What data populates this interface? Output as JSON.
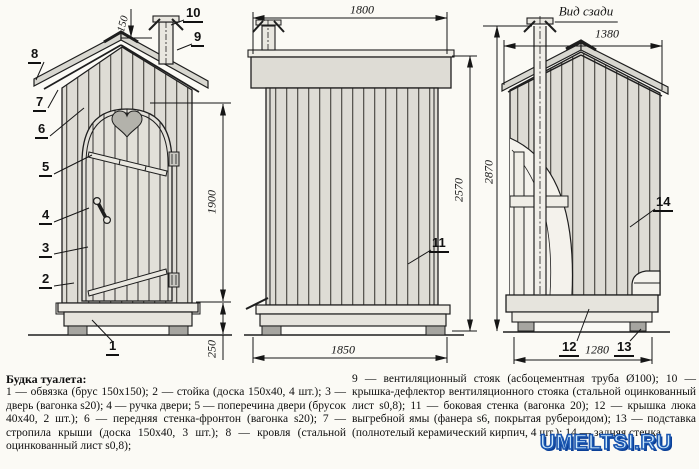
{
  "views": {
    "front": {
      "dim_150": "150",
      "dim_1900": "1900",
      "dim_250": "250"
    },
    "side": {
      "dim_1800": "1800",
      "dim_1850": "1850",
      "dim_2570": "2570"
    },
    "back": {
      "title": "Вид сзади",
      "dim_1380": "1380",
      "dim_2870": "2870",
      "dim_1280": "1280"
    }
  },
  "callouts": {
    "c1": "1",
    "c2": "2",
    "c3": "3",
    "c4": "4",
    "c5": "5",
    "c6": "6",
    "c7": "7",
    "c8": "8",
    "c9": "9",
    "c10": "10",
    "c11": "11",
    "c12": "12",
    "c13": "13",
    "c14": "14"
  },
  "legend": {
    "title": "Будка туалета:",
    "left_items": [
      "1 — обвязка (брус 150х150); ",
      "2 — стойка (доска 150х40, 4 шт.); ",
      "3 — дверь (вагонка s20); ",
      "4 — ручка двери; ",
      "5 — поперечина двери (брусок 40х40, 2 шт.); ",
      "6 — передняя стенка-фронтон (вагонка s20); ",
      "7 — стропила крыши (доска 150х40, 3 шт.); ",
      "8 — кровля (стальной оцинкованный лист s0,8);"
    ],
    "right_items": [
      "9 — вентиляционный стояк (асбоцементная труба Ø100); ",
      "10 — крышка-дефлектор вентиляционного стояка (стальной оцинкованный лист s0,8); ",
      "11 — боковая стенка (вагонка 20); ",
      "12 — крышка люка выгребной ямы (фанера s6, покрытая рубероидом); ",
      "13 — подставка (полнотелый керамический кирпич, 4 шт.); ",
      "14 — задняя стенка"
    ]
  },
  "watermark": "UMELTSI.RU",
  "colors": {
    "line": "#1e1e1e",
    "plank_fill": "#dedcd5",
    "roof_fill": "#d8d7d0",
    "brick": "#a6a5a0",
    "background": "#fbfaf5",
    "watermark_fill": "#cdeafb",
    "watermark_outline": "#1a55b0"
  }
}
